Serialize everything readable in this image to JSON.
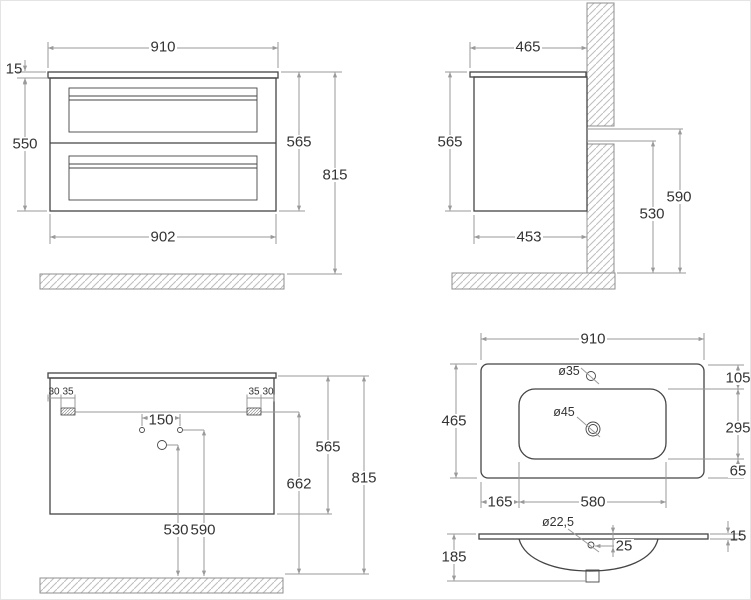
{
  "colors": {
    "background": "#ffffff",
    "object_line": "#454545",
    "dim_line": "#9a9a9a",
    "hatch": "#bdbdbd",
    "hatch_outline": "#8f8f8f",
    "text": "#333333"
  },
  "views": {
    "front": {
      "top_width": "910",
      "counter_thickness": "15",
      "body_height": "550",
      "height_with_top": "565",
      "total_height": "815",
      "body_width": "902"
    },
    "side": {
      "top_depth": "465",
      "height": "565",
      "body_depth": "453",
      "rail_height": "590",
      "rail_bottom_height": "530"
    },
    "back": {
      "left_edge_offset": "30",
      "left_bracket_width": "35",
      "right_bracket_width": "35",
      "right_edge_offset": "30",
      "hole_spacing": "150",
      "height": "565",
      "outlet_height": "662",
      "total_height": "815",
      "hole_height_530": "530",
      "hole_height_590": "590"
    },
    "top": {
      "width": "910",
      "depth": "465",
      "faucet_hole_dia": "ø35",
      "drain_hole_dia": "ø45",
      "back_offset": "105",
      "basin_depth": "295",
      "front_offset": "65",
      "side_offset": "165",
      "basin_width": "580"
    },
    "section": {
      "overflow_hole_dia": "ø22,5",
      "overflow_offset": "25",
      "edge_thickness": "15",
      "total_depth": "185"
    }
  }
}
